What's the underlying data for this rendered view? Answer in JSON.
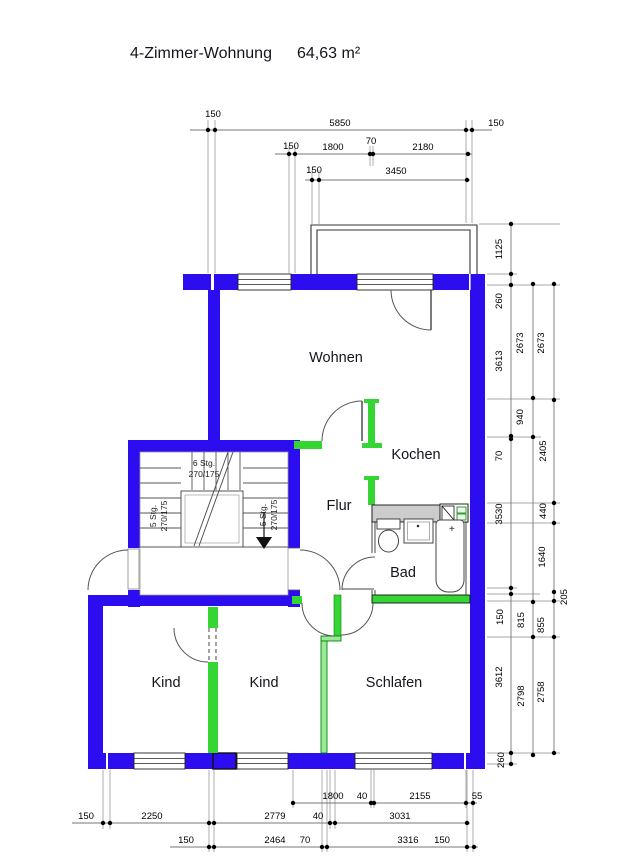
{
  "title": {
    "name": "4-Zimmer-Wohnung",
    "area": "64,63 m²"
  },
  "rooms": {
    "wohnen": "Wohnen",
    "kochen": "Kochen",
    "flur": "Flur",
    "bad": "Bad",
    "kind1": "Kind",
    "kind2": "Kind",
    "schlafen": "Schlafen"
  },
  "stairwell": {
    "flight_top": {
      "line1": "6 Stg.",
      "line2": "270/175"
    },
    "flight_left": {
      "line1": "5 Stg.",
      "line2": "270/175"
    },
    "flight_right": {
      "line1": "5 Stg.",
      "line2": "270/175"
    }
  },
  "marks": {
    "tub_plus": "+"
  },
  "dimensions": {
    "top": {
      "row1": [
        "150",
        "5850",
        "150"
      ],
      "row2": [
        "150",
        "1800",
        "70",
        "2180"
      ],
      "row3": [
        "150",
        "3450"
      ]
    },
    "right": {
      "chain1": [
        "1125",
        "260",
        "3613",
        "70",
        "3530",
        "150",
        "3612",
        "260"
      ],
      "chain2": [
        "2673",
        "940",
        "815",
        "2798"
      ],
      "chain3": [
        "2673",
        "2405",
        "440",
        "1640",
        "205",
        "855",
        "2758"
      ]
    },
    "bottom": {
      "rowA": [
        "1800",
        "40",
        "2155",
        "55"
      ],
      "rowB": [
        "150",
        "2250",
        "2779",
        "40",
        "3031"
      ],
      "rowC": [
        "150",
        "2464",
        "70",
        "3316",
        "150"
      ]
    }
  },
  "colors": {
    "wall": "#2b0df0",
    "partition": "#35d533",
    "partition_light": "#98ea98",
    "partition_dark": "#0b800b",
    "shaft": "#cccccc",
    "dim_line": "#8a8a8a"
  }
}
